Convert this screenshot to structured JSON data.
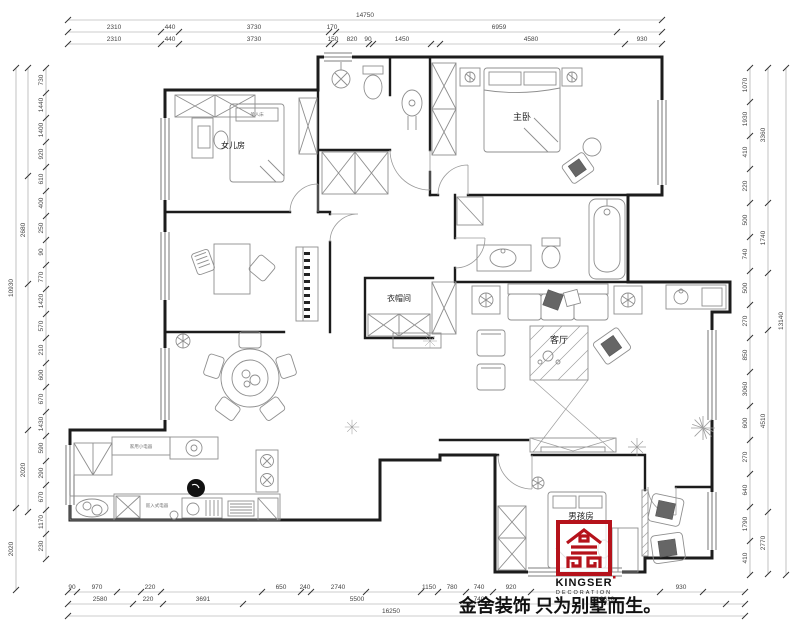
{
  "plan": {
    "rooms": {
      "daughter": "女儿房",
      "master": "主卧",
      "cloak": "衣帽间",
      "living": "客厅",
      "boy": "男孩房"
    },
    "labels": {
      "single_bed": "单人床",
      "appliances": "家用小电器",
      "builtin": "嵌入式电器"
    }
  },
  "logo": {
    "brand": "KINGSER",
    "division": "DECORATION",
    "tagline": "金舍装饰 只为别墅而生。",
    "accent": "#b5121b"
  },
  "dims": {
    "top": {
      "total": "14750",
      "row2": [
        "2310",
        "440",
        "3730",
        "170",
        "6959"
      ],
      "row3": [
        "2310",
        "440",
        "3730",
        "150",
        "820",
        "90",
        "1450",
        "4580",
        "930"
      ]
    },
    "bottom": {
      "row1": [
        "90",
        "970",
        "220",
        "650",
        "240",
        "2740",
        "1150",
        "780",
        "740",
        "920",
        "930"
      ],
      "row2": [
        "2580",
        "220",
        "3691",
        "5500",
        "740",
        "3610"
      ],
      "total": "16250"
    },
    "left": {
      "inner": [
        "730",
        "1440",
        "1400",
        "920",
        "610",
        "400",
        "250",
        "90",
        "770",
        "1420",
        "570",
        "210",
        "600",
        "670",
        "1430",
        "590",
        "290",
        "670",
        "1170",
        "230"
      ],
      "mid": [
        "2680",
        "2020"
      ],
      "outer": [
        "10930",
        "2020"
      ]
    },
    "right": {
      "inner": [
        "1070",
        "1930",
        "410",
        "220",
        "500",
        "740",
        "500",
        "270",
        "850",
        "3060",
        "600",
        "270",
        "640",
        "1790",
        "410"
      ],
      "mid": [
        "3360",
        "1740",
        "4510",
        "2770"
      ],
      "outer": [
        "13140"
      ]
    }
  }
}
